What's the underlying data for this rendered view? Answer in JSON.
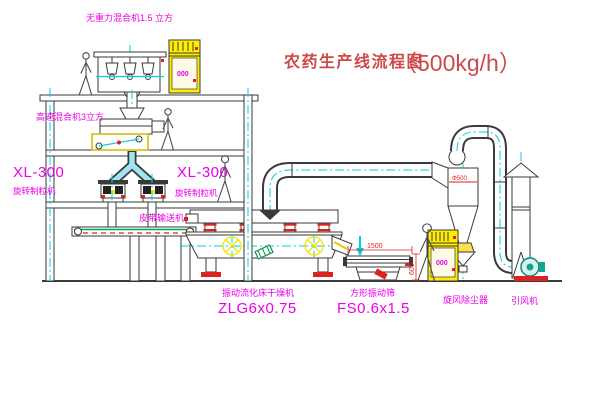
{
  "title": {
    "text": "农药生产线流程图",
    "capacity": "（500kg/h）"
  },
  "equipment_labels": {
    "gravity_free_mixer": "无重力混合机1.5 立方",
    "high_speed_mixer": "高速混合机3立方",
    "granulator_left": {
      "model": "XL-300",
      "name": "旋转制粒机"
    },
    "granulator_right": {
      "model": "XL-300",
      "name": "旋转制粒机"
    },
    "belt_conveyor": "皮带输送机",
    "fluid_bed_dryer": {
      "name": "振动流化床干燥机",
      "model": "ZLG6x0.75"
    },
    "vibrating_sieve": {
      "name": "方形振动筛",
      "model": "FS0.6x1.5"
    },
    "cyclone": "旋风除尘器",
    "fan": "引风机"
  },
  "control_cabinets": {
    "display_top": "000",
    "display_right": "000"
  },
  "dimensions": {
    "sieve_length": "1500",
    "sieve_height": "600",
    "cyclone_mark": "Φ500"
  },
  "colors": {
    "label_magenta": "#e800e8",
    "title_red": "#cd4a4a",
    "accent_red": "#dd2222",
    "line_dark": "#3a3a3a",
    "centerline_cyan": "#00d0e0",
    "cabinet_yellow": "#ffee00",
    "belt_green": "#00a650",
    "fan_teal": "#16a392",
    "chute_cyan": "#9fe4ee",
    "symbol_yellow": "#f5e400"
  }
}
